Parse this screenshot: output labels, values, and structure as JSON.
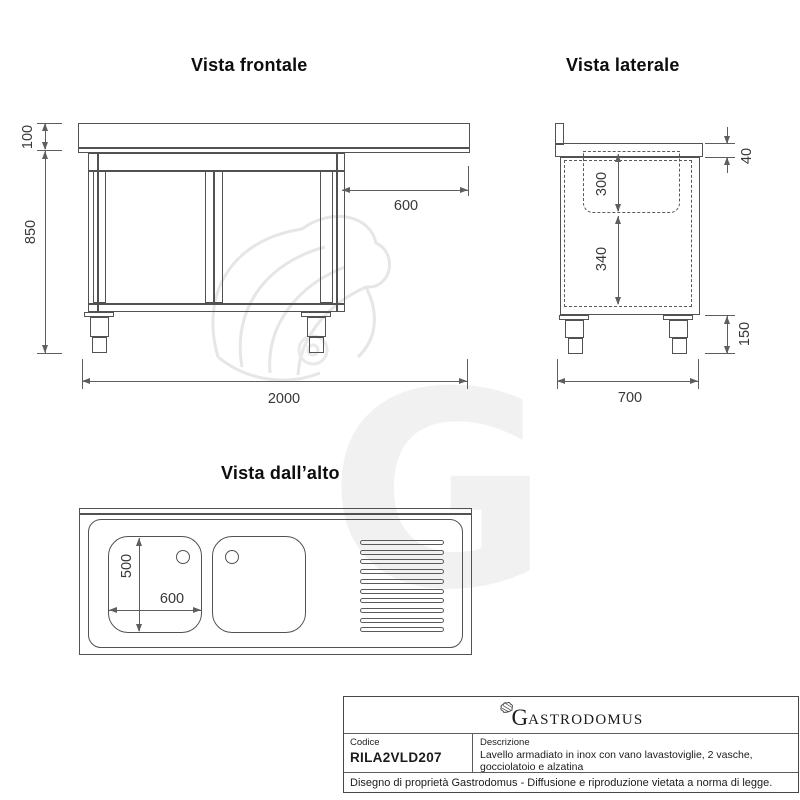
{
  "colors": {
    "line": "#525252",
    "dimension": "#5e5e5e",
    "title": "#0d0d0d",
    "table_border": "#474747",
    "watermark": "#f1f1f1"
  },
  "views": {
    "front": {
      "title": "Vista frontale",
      "dims": {
        "backsplash_height": "100",
        "body_height": "850",
        "overhang_width": "600",
        "total_width": "2000"
      }
    },
    "side": {
      "title": "Vista laterale",
      "dims": {
        "top_thickness": "40",
        "basin_depth": "300",
        "interior_height": "340",
        "leg_height": "150",
        "total_depth": "700"
      }
    },
    "top": {
      "title": "Vista dall’alto",
      "dims": {
        "basin_depth": "500",
        "basin_width": "600"
      },
      "drainboard_lines": 10
    }
  },
  "watermark": {
    "letter": "G"
  },
  "title_block": {
    "logo_initial": "G",
    "logo_rest": "ASTRODOMUS",
    "code_label": "Codice",
    "code_value": "RILA2VLD207",
    "description_label": "Descrizione",
    "description_line1": "Lavello armadiato in inox con vano lavastoviglie, 2 vasche,",
    "description_line2": "gocciolatoio e alzatina",
    "footer": "Disegno di proprietà Gastrodomus -  Diffusione e riproduzione vietata a norma di legge."
  }
}
